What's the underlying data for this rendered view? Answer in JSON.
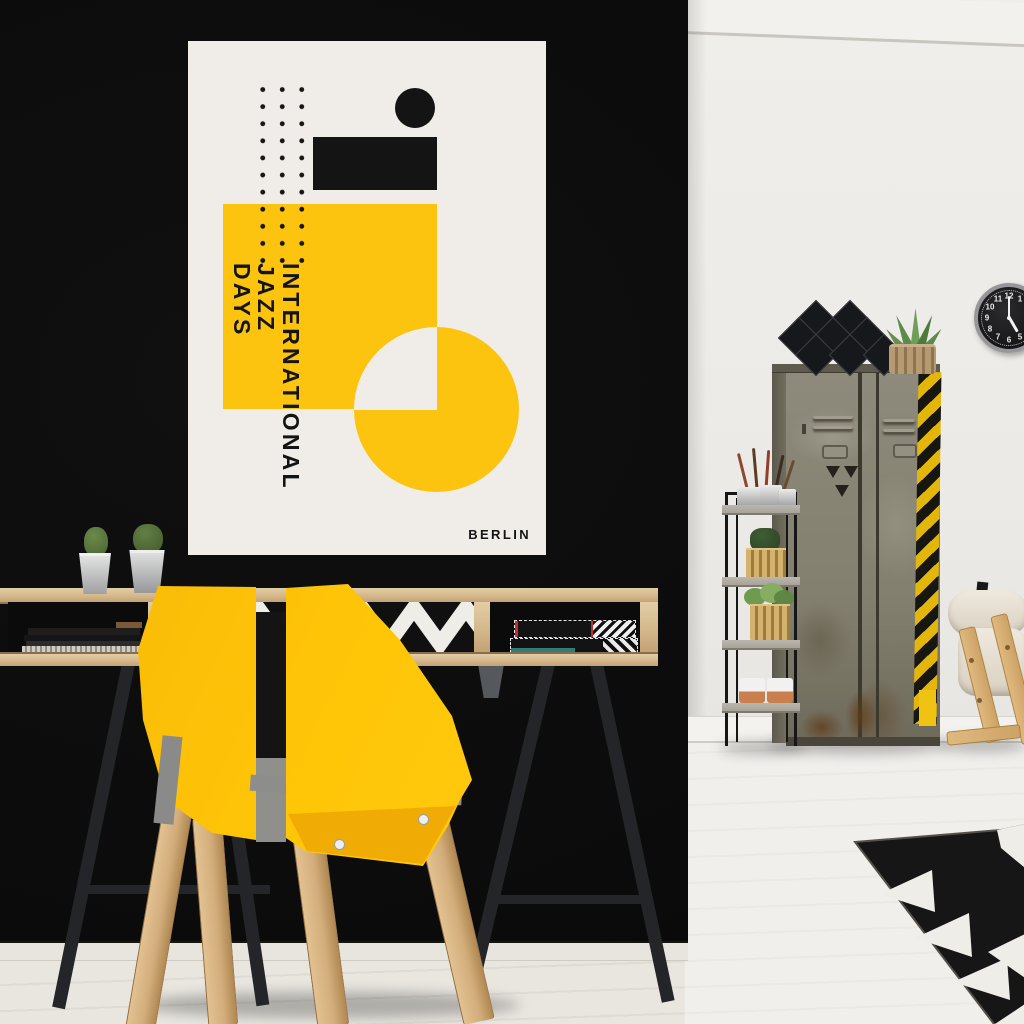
{
  "poster": {
    "title_lines": [
      "INTERNATIONAL",
      "JAZZ",
      "DAYS"
    ],
    "city": "BERLIN",
    "background": "#f0ede8",
    "accent_yellow": "#fcc30f",
    "ink": "#141414"
  },
  "clock": {
    "numerals": {
      "n1": "1",
      "n2": "2",
      "n3": "3",
      "n4": "4",
      "n5": "5",
      "n6": "6",
      "n7": "7",
      "n8": "8",
      "n9": "9",
      "n10": "10",
      "n11": "11",
      "n12": "12"
    }
  },
  "palette": {
    "black_wall": "#0c0c0c",
    "white_wall": "#efedea",
    "floor": "#e9e6e0",
    "chair_yellow": "#ffc608",
    "hazard_yellow": "#e3b60c",
    "locker_gray_green": "#84806f",
    "wood_light": "#d4b88b"
  }
}
